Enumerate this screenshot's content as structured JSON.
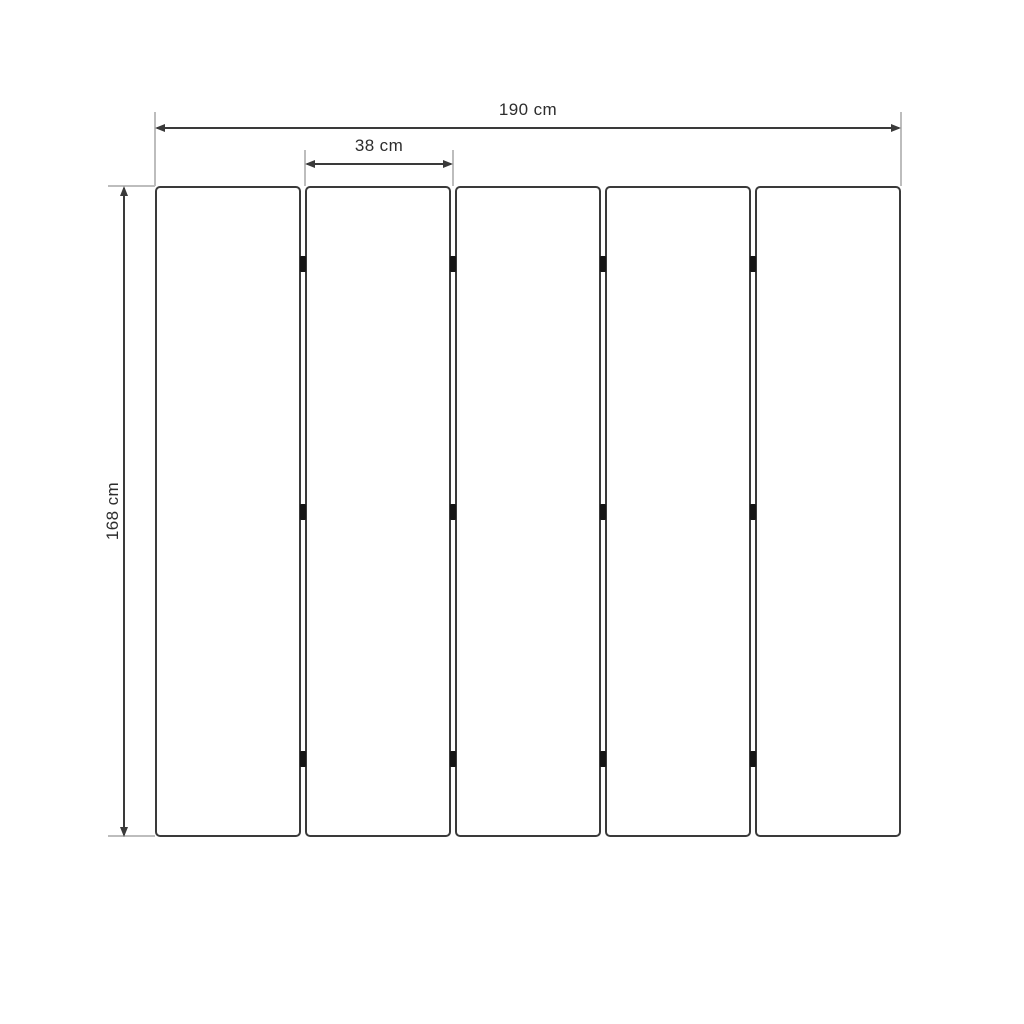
{
  "diagram": {
    "dimensions": {
      "total_width": {
        "label": "190 cm",
        "value": 190,
        "unit": "cm"
      },
      "panel_width": {
        "label": "38 cm",
        "value": 38,
        "unit": "cm"
      },
      "height": {
        "label": "168 cm",
        "value": 168,
        "unit": "cm"
      }
    },
    "panels": {
      "count": 5
    },
    "hinges": {
      "gaps": 4,
      "per_gap": 3,
      "positions_pct": [
        12,
        50,
        88
      ]
    },
    "colors": {
      "dimension_line": "#3a3a3a",
      "extension_line": "#bdbdbd",
      "panel_border": "#3a3a3a",
      "panel_fill": "#ffffff",
      "hinge": "#151515",
      "text": "#2d2d2d",
      "background": "#ffffff"
    }
  }
}
